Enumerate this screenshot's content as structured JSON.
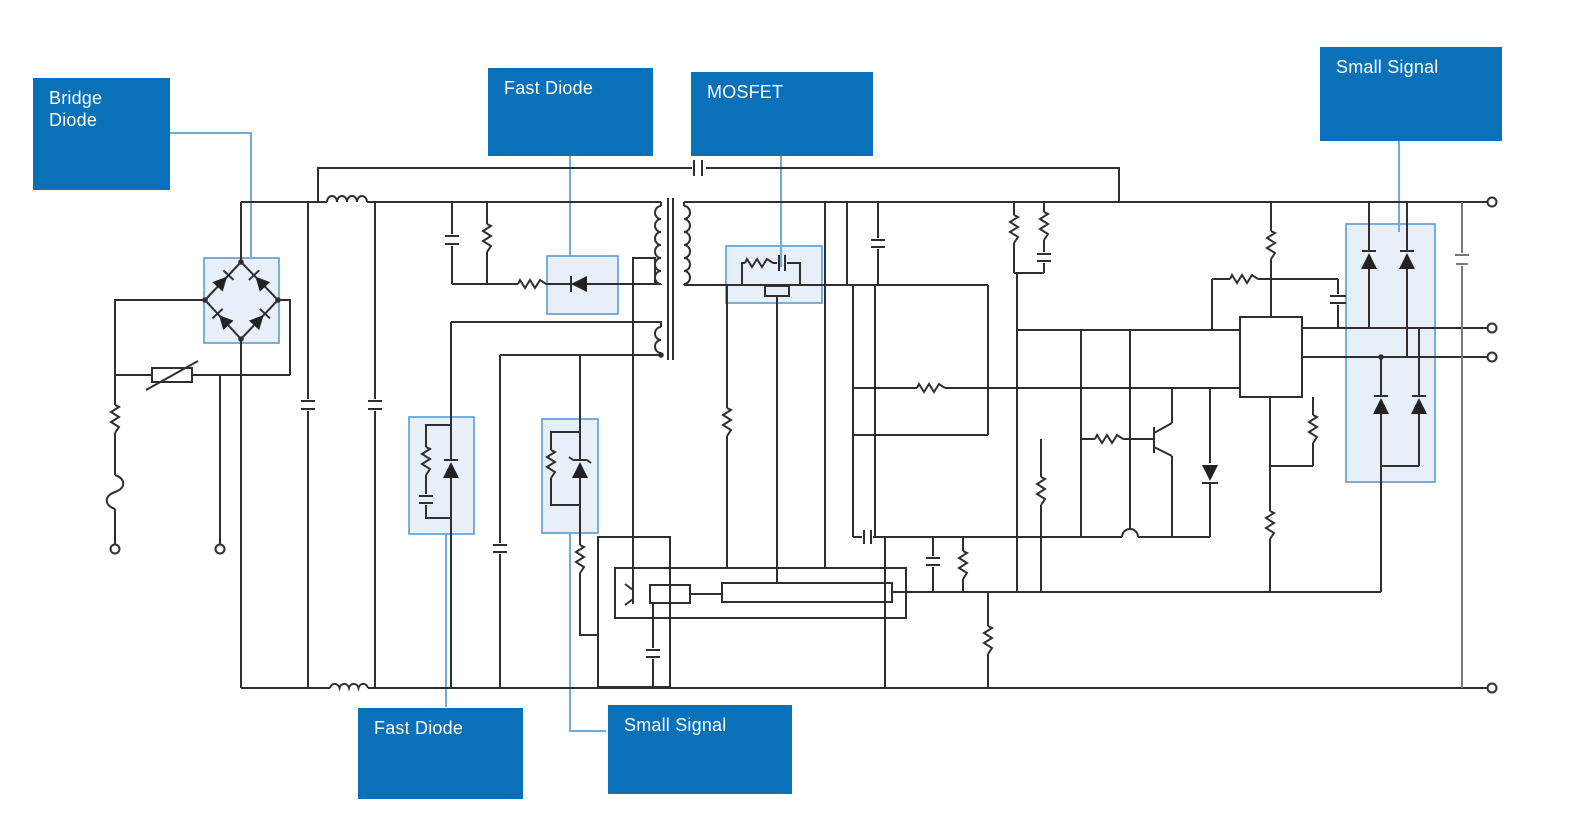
{
  "colors": {
    "callout_bg": "#0a70b8",
    "callout_text": "#ffffff",
    "leader_line": "#74a9dc",
    "highlight_border": "#5b9bd5",
    "highlight_fill": "#cfe2f3",
    "wire": "#2f2f2f",
    "background": "#ffffff"
  },
  "callouts": [
    {
      "id": "bridge-diode",
      "label": "Bridge Diode"
    },
    {
      "id": "fast-diode-top",
      "label": "Fast Diode"
    },
    {
      "id": "mosfet",
      "label": "MOSFET"
    },
    {
      "id": "small-signal-right",
      "label": "Small Signal"
    },
    {
      "id": "fast-diode-bottom",
      "label": "Fast Diode"
    },
    {
      "id": "small-signal-bottom",
      "label": "Small Signal"
    }
  ],
  "schematic": {
    "type": "switch-mode-power-supply-circuit",
    "highlighted_components": [
      "bridge-diode-rectifier",
      "fast-diode-clamp",
      "mosfet-with-snubber",
      "small-signal-diode-pairs",
      "fast-diode-secondary",
      "small-signal-zener"
    ]
  }
}
